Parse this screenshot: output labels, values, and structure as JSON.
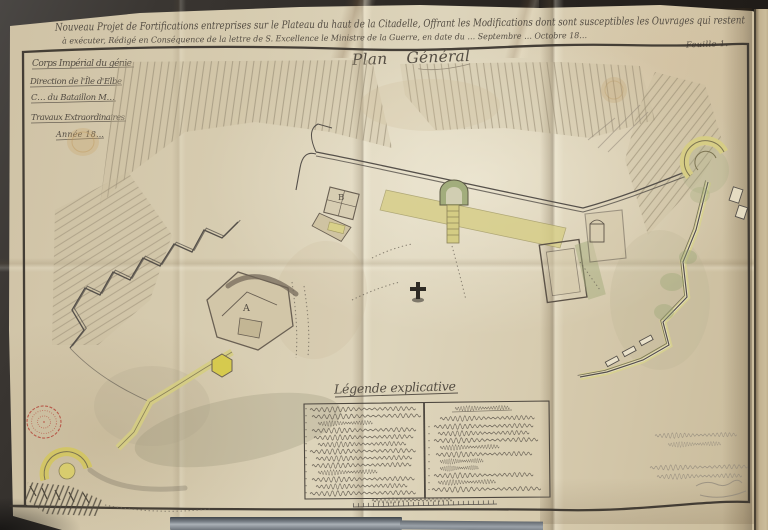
{
  "document": {
    "title_line1": "Nouveau Projet de Fortifications entreprises sur le Plateau du haut de la Citadelle, Offrant les Modifications dont sont susceptibles les Ouvrages qui restent",
    "title_line2": "à exécuter, Rédigé en Conséquence de la lettre de S. Excellence le Ministre de la Guerre, en date du … Septembre … Octobre 18…",
    "sheet_label": "Feuille 1.",
    "plan_title": "Plan Général",
    "cartouche": {
      "line1": "Corps Impérial du génie",
      "line2": "Direction de l'Île d'Elbe",
      "line3": "C… du Bataillon M…",
      "line4": "Travaux Extraordinaires",
      "line5": "Année 18…"
    },
    "legend": {
      "title": "Légende explicative"
    },
    "map_labels": {
      "bastion_a": "A",
      "work_b": "B"
    }
  },
  "palette": {
    "paper": "#d8cdb2",
    "ink": "#534c42",
    "wash_yellow": "#d6cd85",
    "wash_green": "#a2ad7c",
    "stamp_red": "#b5493c",
    "backdrop": "#2b2723",
    "metal_gray": "#8d949b"
  }
}
